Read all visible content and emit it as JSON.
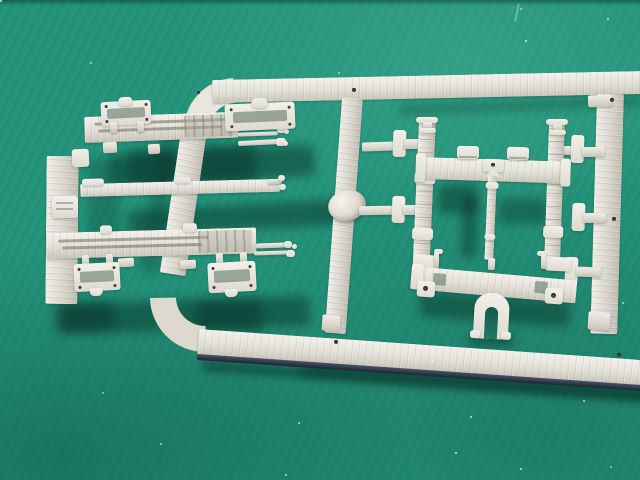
{
  "meta": {
    "type": "photograph",
    "description": "Light grey injection-moulded plastic model-kit sprue lying on a green self-healing cutting mat",
    "text_content": "none"
  },
  "palette": {
    "mat_green": "#23937a",
    "mat_shadow_green": "#0a3a2e",
    "plastic_light": "#f1efe9",
    "plastic_base": "#d8d4ca",
    "plastic_shade": "#bfbbb0",
    "rail_dark_edge": "#232940",
    "pin_mark_brown": "#4c4337"
  },
  "objects": {
    "mat": {
      "label": "green cutting mat background"
    },
    "sprue": {
      "label": "plastic sprue runner frame with rounded corners"
    },
    "top_rail": {
      "label": "sprue top rail"
    },
    "left_rail": {
      "label": "sprue left rail"
    },
    "bottom_rail": {
      "label": "sprue bottom rail with dark shadowed edge"
    },
    "center_runner": {
      "label": "central runner with oval injection-gate boss"
    },
    "right_runner": {
      "label": "right vertical runner with brushed texture"
    },
    "underframe": {
      "label": "wagon underframe part with side board, three beams and brake rigging"
    },
    "platforms": {
      "label": "four small platform frames with corner holes"
    },
    "bolster": {
      "label": "bolster sub-assembly: two posts, top and bottom beams, brake rod, arch and brackets"
    },
    "marks": {
      "label": "ejector pin marks on runners"
    },
    "dust": {
      "label": "dust specks on mat"
    }
  }
}
